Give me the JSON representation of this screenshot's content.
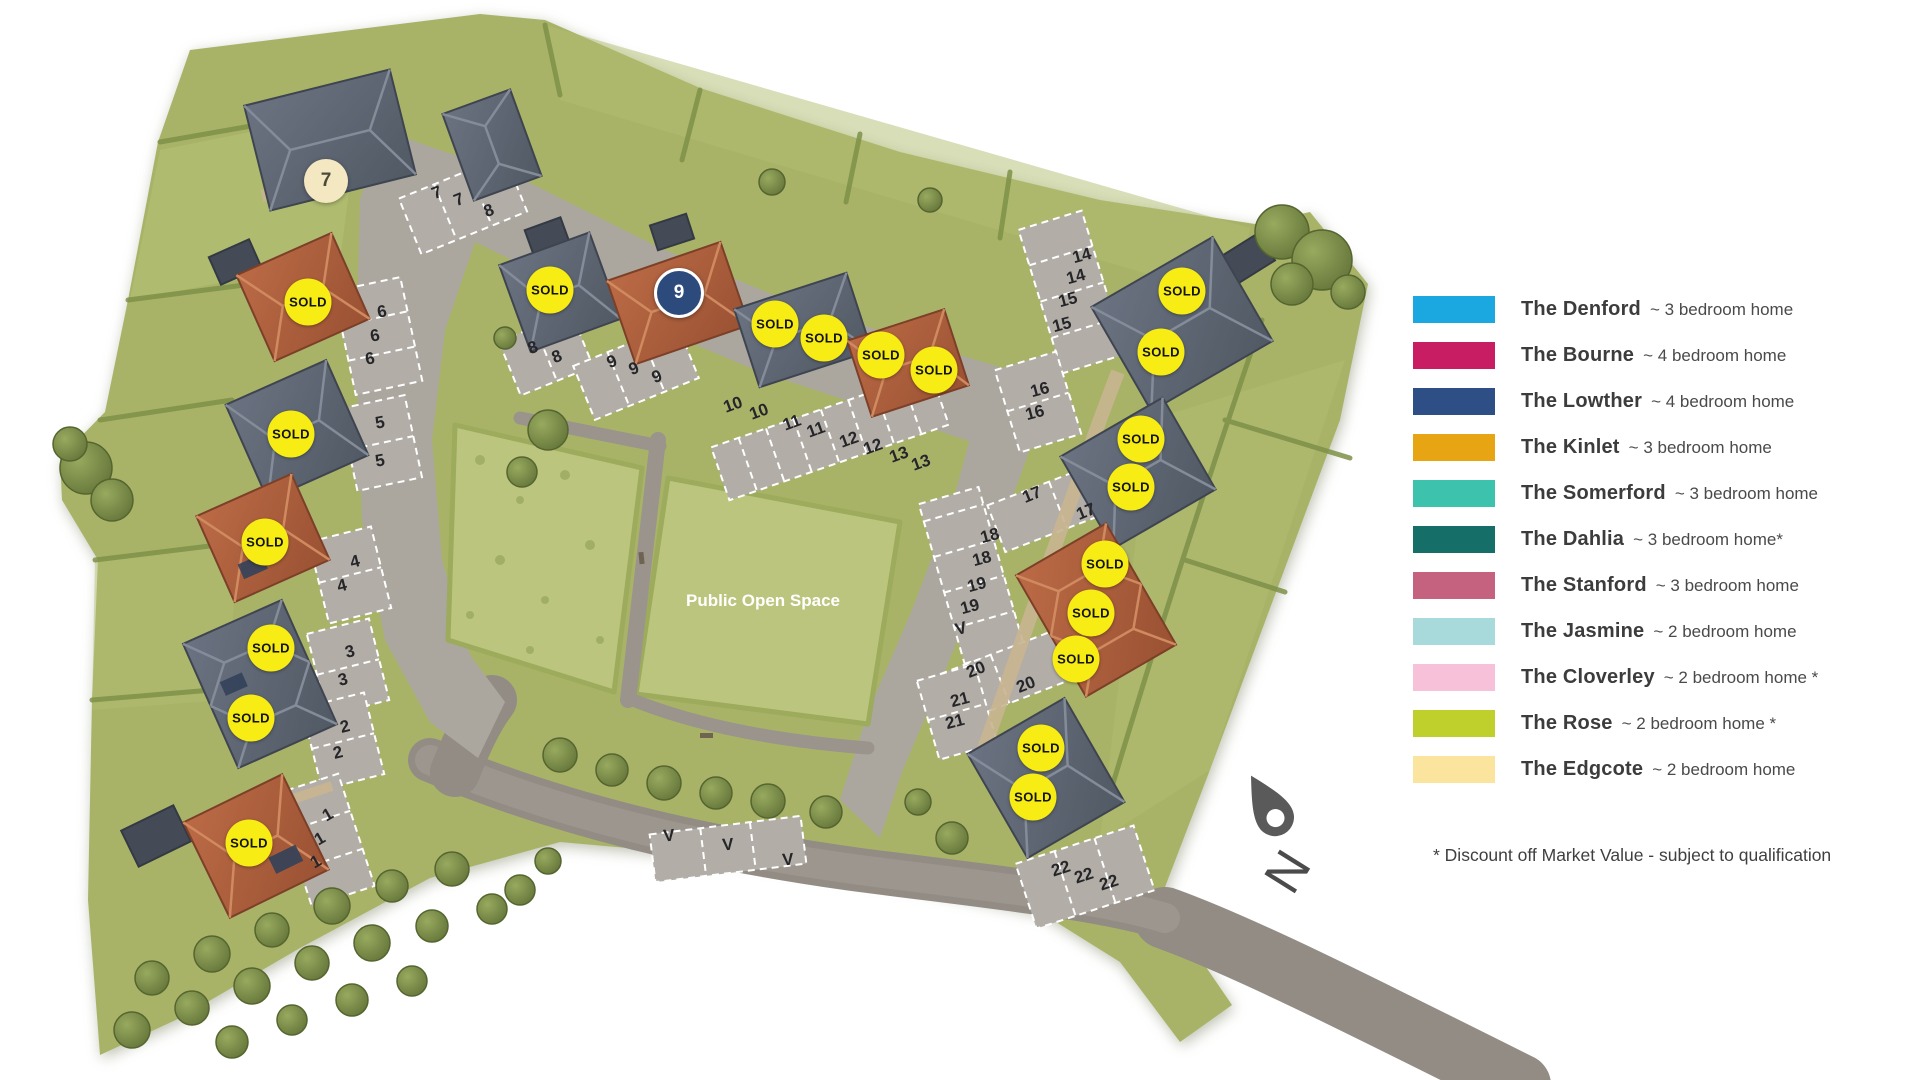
{
  "legend": {
    "items": [
      {
        "name": "The Denford",
        "desc": "~ 3 bedroom home",
        "color": "#1ba7e0"
      },
      {
        "name": "The Bourne",
        "desc": "~ 4 bedroom home",
        "color": "#c91d63"
      },
      {
        "name": "The Lowther",
        "desc": "~ 4 bedroom home",
        "color": "#2e4f86"
      },
      {
        "name": "The Kinlet",
        "desc": "~ 3 bedroom home",
        "color": "#e7a514"
      },
      {
        "name": "The Somerford",
        "desc": "~ 3 bedroom home",
        "color": "#3dc3ad"
      },
      {
        "name": "The Dahlia",
        "desc": "~ 3 bedroom home*",
        "color": "#156f68"
      },
      {
        "name": "The Stanford",
        "desc": "~ 3 bedroom home",
        "color": "#c4627f"
      },
      {
        "name": "The Jasmine",
        "desc": "~ 2 bedroom home",
        "color": "#a9dadb"
      },
      {
        "name": "The Cloverley",
        "desc": "~ 2 bedroom home *",
        "color": "#f7c1d9"
      },
      {
        "name": "The Rose",
        "desc": "~ 2 bedroom home *",
        "color": "#bfcf2c"
      },
      {
        "name": "The Edgcote",
        "desc": "~ 2 bedroom home",
        "color": "#fbe49e"
      }
    ],
    "disclaimer": "* Discount off Market Value - subject to qualification"
  },
  "map": {
    "open_space_label": "Public Open Space",
    "north_label": "N",
    "sold_label": "SOLD",
    "sold_color": "#f7ec13",
    "marker_cream_color": "#f3e8c2",
    "marker_navy_color": "#2c4a7c",
    "markers": [
      {
        "label": "7",
        "x": 326,
        "y": 181,
        "style": "cream"
      },
      {
        "label": "9",
        "x": 679,
        "y": 293,
        "style": "navy"
      }
    ],
    "sold_badges": [
      {
        "x": 308,
        "y": 302
      },
      {
        "x": 291,
        "y": 434
      },
      {
        "x": 265,
        "y": 542
      },
      {
        "x": 271,
        "y": 648
      },
      {
        "x": 251,
        "y": 718
      },
      {
        "x": 249,
        "y": 843
      },
      {
        "x": 550,
        "y": 290
      },
      {
        "x": 775,
        "y": 324
      },
      {
        "x": 824,
        "y": 338
      },
      {
        "x": 881,
        "y": 355
      },
      {
        "x": 934,
        "y": 370
      },
      {
        "x": 1182,
        "y": 291
      },
      {
        "x": 1161,
        "y": 352
      },
      {
        "x": 1141,
        "y": 439
      },
      {
        "x": 1131,
        "y": 487
      },
      {
        "x": 1105,
        "y": 564
      },
      {
        "x": 1091,
        "y": 613
      },
      {
        "x": 1076,
        "y": 659
      },
      {
        "x": 1041,
        "y": 748
      },
      {
        "x": 1033,
        "y": 797
      }
    ],
    "plot_labels": [
      {
        "label": "7",
        "x": 437,
        "y": 193,
        "rot": -22
      },
      {
        "label": "7",
        "x": 459,
        "y": 200,
        "rot": -22
      },
      {
        "label": "8",
        "x": 489,
        "y": 211,
        "rot": -22
      },
      {
        "label": "8",
        "x": 533,
        "y": 348,
        "rot": -22
      },
      {
        "label": "8",
        "x": 557,
        "y": 357,
        "rot": -22
      },
      {
        "label": "9",
        "x": 612,
        "y": 362,
        "rot": -22
      },
      {
        "label": "9",
        "x": 634,
        "y": 369,
        "rot": -22
      },
      {
        "label": "9",
        "x": 657,
        "y": 377,
        "rot": -22
      },
      {
        "label": "10",
        "x": 733,
        "y": 405,
        "rot": -20
      },
      {
        "label": "10",
        "x": 759,
        "y": 412,
        "rot": -20
      },
      {
        "label": "11",
        "x": 792,
        "y": 423,
        "rot": -20
      },
      {
        "label": "11",
        "x": 816,
        "y": 430,
        "rot": -20
      },
      {
        "label": "12",
        "x": 849,
        "y": 440,
        "rot": -20
      },
      {
        "label": "12",
        "x": 873,
        "y": 447,
        "rot": -20
      },
      {
        "label": "13",
        "x": 899,
        "y": 455,
        "rot": -20
      },
      {
        "label": "13",
        "x": 921,
        "y": 463,
        "rot": -20
      },
      {
        "label": "6",
        "x": 382,
        "y": 312,
        "rot": -10
      },
      {
        "label": "6",
        "x": 375,
        "y": 336,
        "rot": -10
      },
      {
        "label": "6",
        "x": 370,
        "y": 359,
        "rot": -10
      },
      {
        "label": "5",
        "x": 380,
        "y": 423,
        "rot": -10
      },
      {
        "label": "5",
        "x": 380,
        "y": 461,
        "rot": -10
      },
      {
        "label": "4",
        "x": 355,
        "y": 562,
        "rot": -14
      },
      {
        "label": "4",
        "x": 342,
        "y": 586,
        "rot": -14
      },
      {
        "label": "3",
        "x": 350,
        "y": 652,
        "rot": -14
      },
      {
        "label": "3",
        "x": 343,
        "y": 680,
        "rot": -14
      },
      {
        "label": "2",
        "x": 345,
        "y": 727,
        "rot": -14
      },
      {
        "label": "2",
        "x": 338,
        "y": 753,
        "rot": -14
      },
      {
        "label": "1",
        "x": 328,
        "y": 815,
        "rot": -30
      },
      {
        "label": "1",
        "x": 320,
        "y": 839,
        "rot": -30
      },
      {
        "label": "1",
        "x": 316,
        "y": 862,
        "rot": -30
      },
      {
        "label": "14",
        "x": 1082,
        "y": 256,
        "rot": -15
      },
      {
        "label": "14",
        "x": 1076,
        "y": 277,
        "rot": -15
      },
      {
        "label": "15",
        "x": 1068,
        "y": 300,
        "rot": -15
      },
      {
        "label": "15",
        "x": 1062,
        "y": 325,
        "rot": -15
      },
      {
        "label": "16",
        "x": 1040,
        "y": 390,
        "rot": -15
      },
      {
        "label": "16",
        "x": 1035,
        "y": 413,
        "rot": -15
      },
      {
        "label": "17",
        "x": 1032,
        "y": 495,
        "rot": -22
      },
      {
        "label": "17",
        "x": 1086,
        "y": 512,
        "rot": -22
      },
      {
        "label": "18",
        "x": 990,
        "y": 536,
        "rot": -15
      },
      {
        "label": "18",
        "x": 982,
        "y": 559,
        "rot": -15
      },
      {
        "label": "19",
        "x": 977,
        "y": 585,
        "rot": -15
      },
      {
        "label": "19",
        "x": 970,
        "y": 607,
        "rot": -15
      },
      {
        "label": "V",
        "x": 961,
        "y": 629,
        "rot": -15
      },
      {
        "label": "20",
        "x": 976,
        "y": 670,
        "rot": -22
      },
      {
        "label": "20",
        "x": 1026,
        "y": 685,
        "rot": -22
      },
      {
        "label": "21",
        "x": 960,
        "y": 700,
        "rot": -15
      },
      {
        "label": "21",
        "x": 955,
        "y": 722,
        "rot": -15
      },
      {
        "label": "22",
        "x": 1061,
        "y": 869,
        "rot": -18
      },
      {
        "label": "22",
        "x": 1084,
        "y": 876,
        "rot": -18
      },
      {
        "label": "22",
        "x": 1109,
        "y": 883,
        "rot": -18
      },
      {
        "label": "V",
        "x": 669,
        "y": 836,
        "rot": -5
      },
      {
        "label": "V",
        "x": 728,
        "y": 845,
        "rot": -5
      },
      {
        "label": "V",
        "x": 788,
        "y": 860,
        "rot": -5
      }
    ]
  }
}
